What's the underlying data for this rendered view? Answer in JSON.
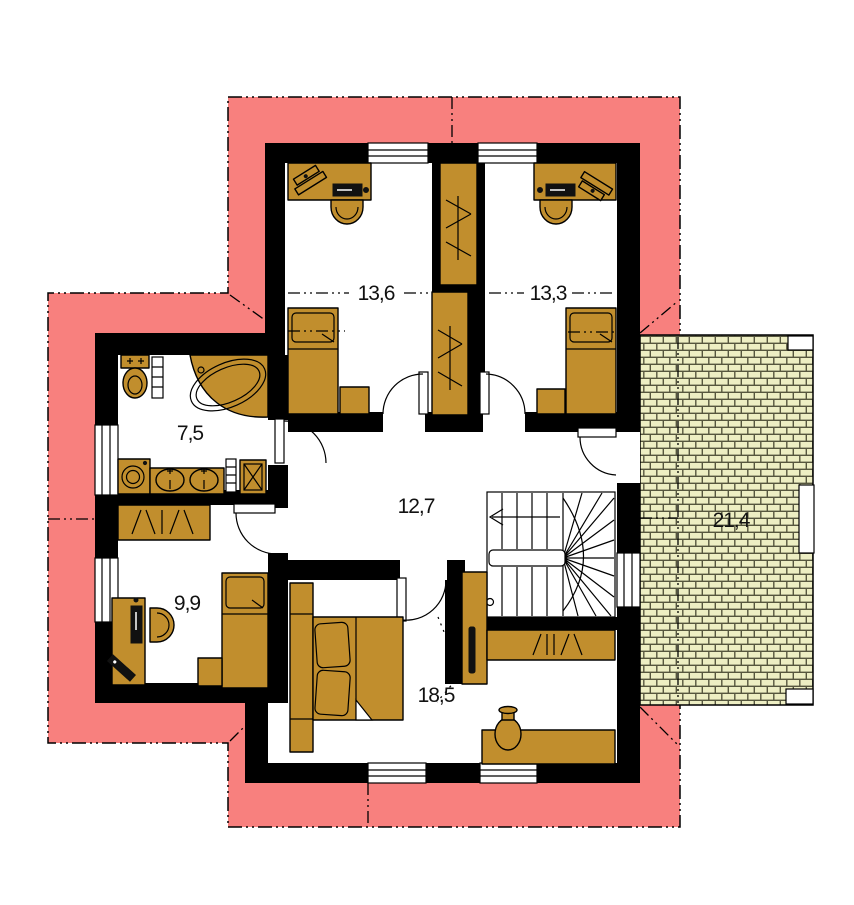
{
  "plan": {
    "type": "floor-plan-upper-storey",
    "rooms": {
      "room_13_6": {
        "area": "13,6"
      },
      "room_13_3": {
        "area": "13,3"
      },
      "bathroom": {
        "area": "7,5"
      },
      "hall": {
        "area": "12,7"
      },
      "room_9_9": {
        "area": "9,9"
      },
      "bedroom": {
        "area": "18,5"
      },
      "terrace": {
        "area": "21,4"
      }
    }
  },
  "colors": {
    "roof_overhang": "#F8807E",
    "furniture": "#C18E2D",
    "wall": "#000000",
    "floor": "#FFFFFF",
    "terrace_brick": "#EDEEC3",
    "terrace_mortar": "#56563E"
  },
  "furniture_icons": [
    "double-bed-icon",
    "single-bed-icon",
    "desk-icon",
    "office-chair-icon",
    "wardrobe-icon",
    "toilet-icon",
    "corner-bathtub-icon",
    "washing-machine-icon",
    "double-sink-icon",
    "shower-icon",
    "radiator-icon",
    "staircase-icon",
    "stair-direction-arrow-icon",
    "vase-icon",
    "tall-cabinet-icon",
    "laptop-icon",
    "keyboard-icon",
    "door-swing-icon",
    "window-icon"
  ]
}
